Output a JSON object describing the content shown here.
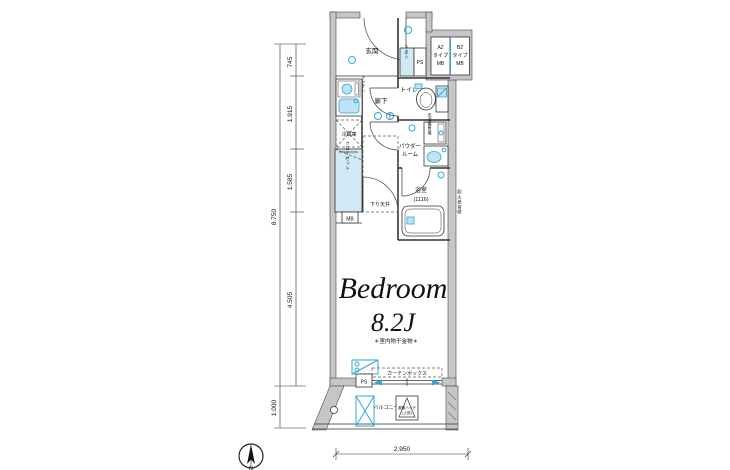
{
  "rooms": {
    "entry": "玄関",
    "hallway": "廊下",
    "toilet": "トイレ",
    "powder_line1": "パウダー",
    "powder_line2": "ルーム",
    "bath": "浴室",
    "bath_size": "(1116)",
    "bedroom_name": "Bedroom",
    "bedroom_size": "8.2J",
    "balcony": "バルコニー"
  },
  "features": {
    "shoe_box": "下足入",
    "ps_top": "PS",
    "ps_bottom": "PS",
    "mb_small": "MB",
    "mb_a2_l1": "A2",
    "mb_a2_l2": "タイプ",
    "mb_a2_l3": "MB",
    "mb_b2_l1": "B2",
    "mb_b2_l2": "タイプ",
    "mb_b2_l3": "MB",
    "kitchen": "キッチン",
    "fridge": "冷蔵庫",
    "closet": "クローゼット",
    "washer": "洗濯機置場",
    "lowered_ceiling": "下り天井",
    "curtain_box": "カーテンボックス",
    "indoor_drying": "＊室内物干金物＊",
    "escape_hatch_l1": "避難ハッチ",
    "escape_hatch_l2": "(上部)",
    "wall_note": "耐火遮音壁"
  },
  "dimensions": {
    "left_total": "8.750",
    "seg1": "745",
    "seg2": "1.915",
    "seg3": "1.585",
    "seg4": "4.505",
    "seg5": "1.000",
    "bottom": "2.950"
  },
  "compass": {
    "north": "N"
  },
  "colors": {
    "accent": "#2ea8d6",
    "accent_fill": "#bfe3f2",
    "wall": "#c6c6c6",
    "line": "#333333"
  }
}
